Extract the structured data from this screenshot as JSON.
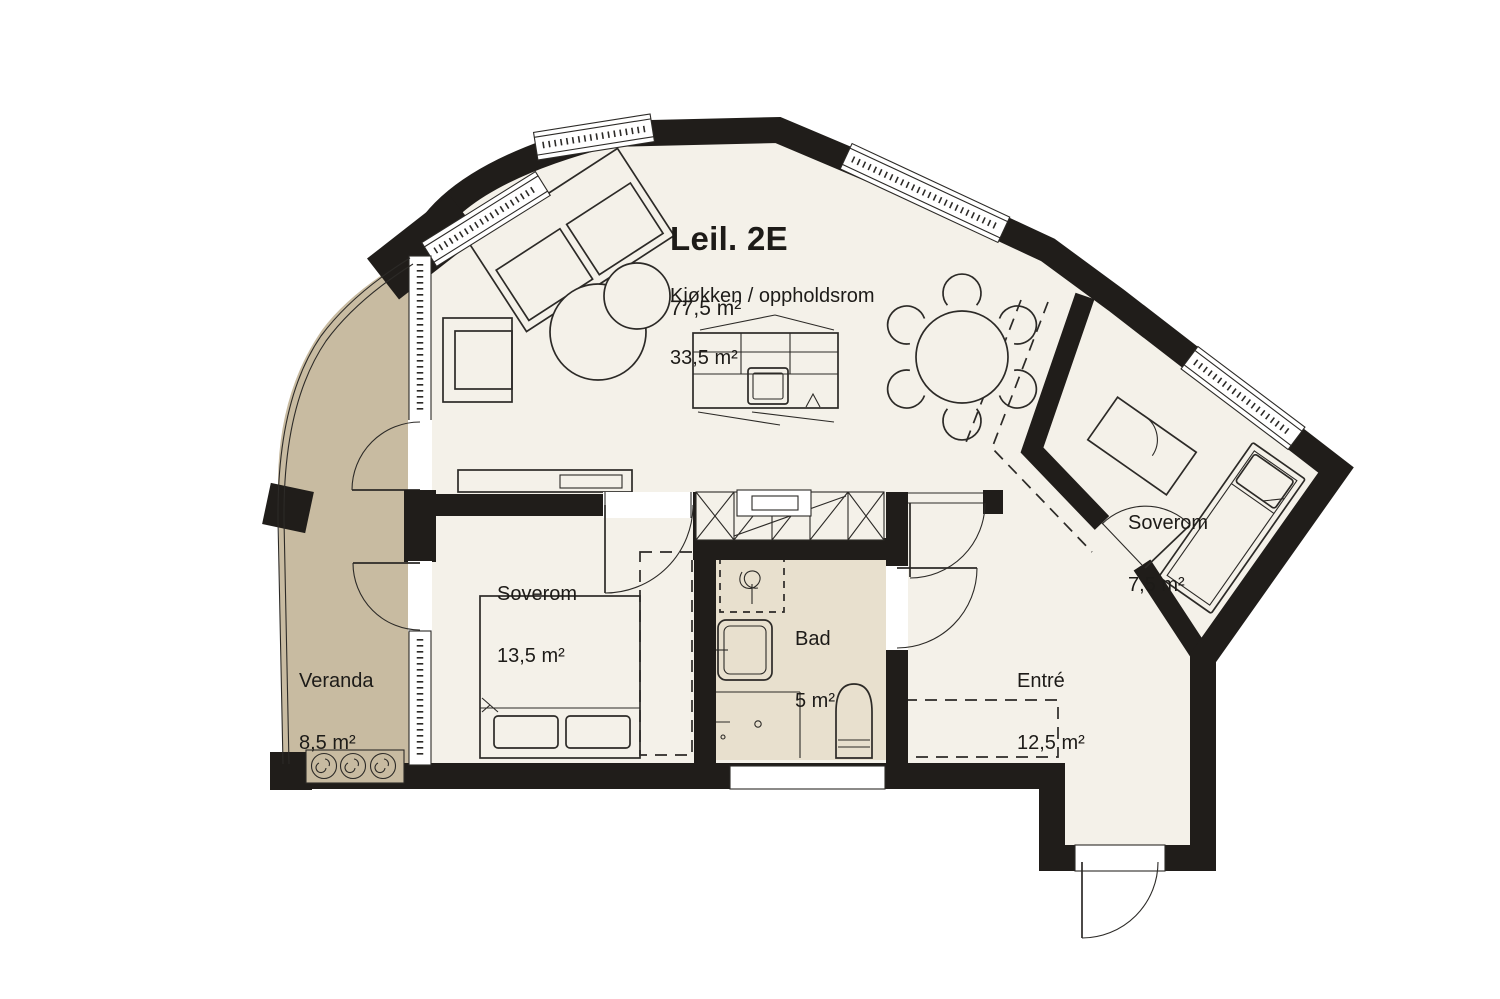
{
  "floorplan": {
    "unit": {
      "title": "Leil. 2E",
      "area": "77,5 m²"
    },
    "rooms": [
      {
        "id": "kitchen_living",
        "name": "Kjøkken / oppholdsrom",
        "area": "33,5 m²"
      },
      {
        "id": "bedroom_1",
        "name": "Soverom",
        "area": "13,5 m²"
      },
      {
        "id": "bedroom_2",
        "name": "Soverom",
        "area": "7,5 m²"
      },
      {
        "id": "bathroom",
        "name": "Bad",
        "area": "5 m²"
      },
      {
        "id": "entry",
        "name": "Entré",
        "area": "12,5 m²"
      },
      {
        "id": "veranda",
        "name": "Veranda",
        "area": "8,5 m²"
      }
    ],
    "colors": {
      "wall": "#201d1a",
      "line": "#2c2a27",
      "floor": "#f4f1e9",
      "veranda_floor": "#c8bba1",
      "bathroom_floor": "#e8e0ce",
      "background": "#ffffff"
    }
  }
}
